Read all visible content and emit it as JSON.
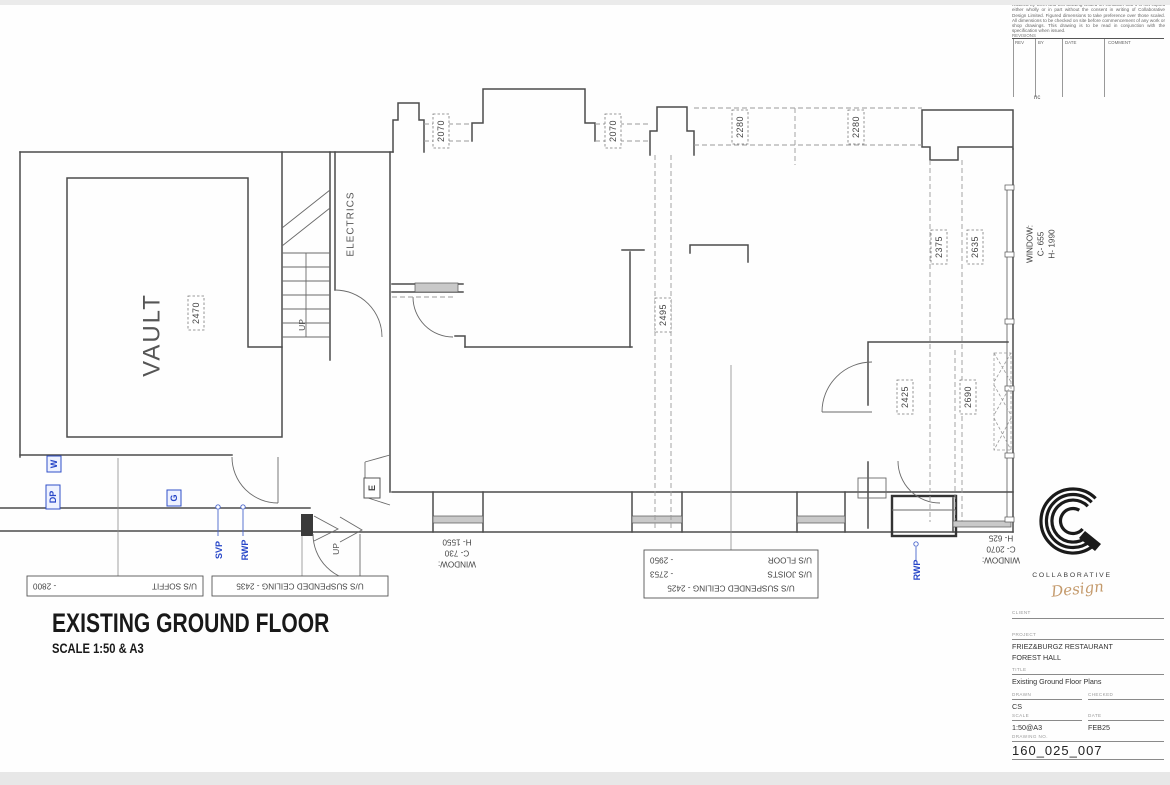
{
  "drawing_title": {
    "line1": "EXISTING GROUND FLOOR",
    "line2": "SCALE 1:50 & A3"
  },
  "plan": {
    "rooms": {
      "vault": "VAULT",
      "electrics": "ELECTRICS"
    },
    "stairs": {
      "up_lower": "UP",
      "up_entrance": "UP",
      "electric_meter": "E"
    },
    "dims": {
      "d2070a": "2070",
      "d2070b": "2070",
      "d2280a": "2280",
      "d2280b": "2280",
      "d2375": "2375",
      "d2635": "2635",
      "d2495": "2495",
      "d2470": "2470",
      "d2425": "2425",
      "d2690": "2690"
    },
    "utilities": {
      "w": "W",
      "dp": "DP",
      "g": "G",
      "svp": "SVP",
      "rwp_left": "RWP",
      "rwp_right": "RWP"
    },
    "windows": {
      "bl1": "WINDOW:",
      "bl2": "C- 730",
      "bl3": "H- 1550",
      "br1": "WINDOW:",
      "br2": "C- 2070",
      "br3": "H- 625",
      "r1": "WINDOW:",
      "r2": "C- 655",
      "r3": "H- 1990"
    },
    "ceiling_notes": {
      "soffit_label": "U/S SOFFIT",
      "soffit_value": "-  2800",
      "suspended": "U/S SUSPENDED CEILING - 2435",
      "multi1": "U/S SUSPENDED CEILING - 2425",
      "multi2_label": "U/S JOISTS",
      "multi2_value": "-  2753",
      "multi3_label": "U/S FLOOR",
      "multi3_value": "-  2950"
    }
  },
  "side_panel": {
    "disclaimer": "retained by them and this drawing issued on condition that it is not copied either wholly or in part without the consent in writing of Collaborative Design Limited. Figured dimensions to take preference over those scaled. All dimensions to be checked on site before commencement of any work or shop drawings. This drawing is to be read in conjunction with the specification when issued.",
    "revisions": {
      "heading": "REVISIONS",
      "col_rev": "REV",
      "col_by": "BY",
      "col_date": "DATE",
      "col_comment": "COMMENT"
    },
    "margin_note": "nc",
    "logo": {
      "wordmark": "COLLABORATIVE",
      "script": "Design"
    },
    "titleblock": {
      "client_label": "CLIENT",
      "project_label": "PROJECT",
      "project_line1": "FRIEZ&BURGZ RESTAURANT",
      "project_line2": "FOREST HALL",
      "title_label": "TITLE",
      "title_value": "Existing Ground Floor Plans",
      "drawn_label": "DRAWN",
      "drawn_value": "CS",
      "checked_label": "CHECKED",
      "scale_label": "SCALE",
      "scale_value": "1:50@A3",
      "date_label": "DATE",
      "date_value": "FEB25",
      "number_label": "DRAWING NO.",
      "number_value": "160_025_007"
    }
  }
}
